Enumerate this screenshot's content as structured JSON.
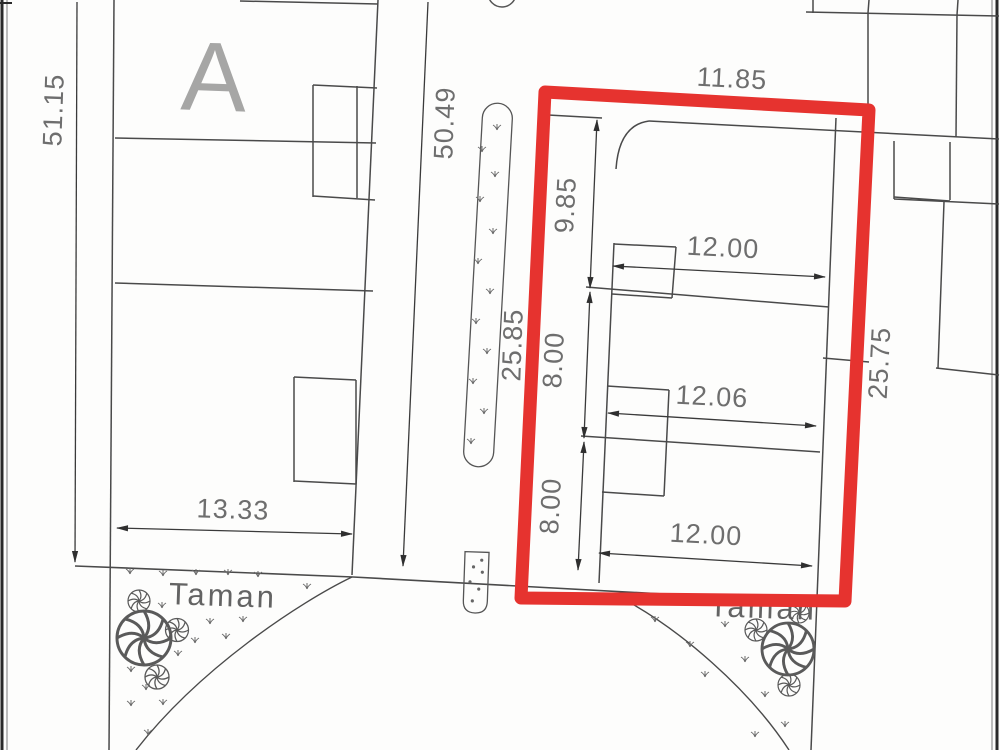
{
  "drawing": {
    "block_label": "A",
    "parks": {
      "left_label": "Taman",
      "right_label": "Taman"
    },
    "dimensions": {
      "west_boundary_length": "51.15",
      "road_length": "50.49",
      "highlight_frontage_left": "25.85",
      "highlight_top_width": "11.85",
      "highlight_right_length": "25.75",
      "block_a_south_width": "13.33",
      "lot_top_depth": "9.85",
      "lot_mid_depth": "8.00",
      "lot_bottom_depth": "8.00",
      "lot_top_width": "12.00",
      "lot_mid_width": "12.06",
      "lot_bottom_width": "12.00"
    },
    "colors": {
      "highlight_red": "#e6332f",
      "line_dark": "#3f3f3f",
      "dim_text_gray": "#6e6e6e"
    }
  }
}
